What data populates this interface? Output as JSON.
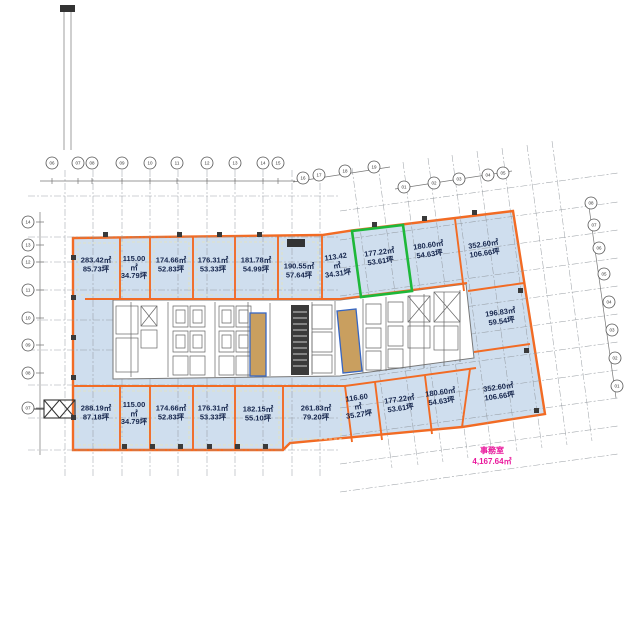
{
  "colors": {
    "lease": "#f26b24",
    "room": "#cfdeee",
    "grid": "#8f959b",
    "green": "#1db83a",
    "strip": "#c99f5f",
    "stripline": "#3766c2",
    "labeltxt": "#15254c",
    "pink": "#e9189c"
  },
  "note": {
    "label": "事務室",
    "value": "4,167.64㎡"
  },
  "rooms": [
    {
      "area": "283.42㎡",
      "tsubo": "85.73坪",
      "x": 96,
      "y": 265,
      "rot": 0,
      "narrow": false,
      "highlight": ""
    },
    {
      "area": "115.00㎡",
      "tsubo": "34.79坪",
      "x": 134,
      "y": 268,
      "rot": 0,
      "narrow": true,
      "highlight": ""
    },
    {
      "area": "174.66㎡",
      "tsubo": "52.83坪",
      "x": 171,
      "y": 265,
      "rot": 0,
      "narrow": false,
      "highlight": ""
    },
    {
      "area": "176.31㎡",
      "tsubo": "53.33坪",
      "x": 213,
      "y": 265,
      "rot": 0,
      "narrow": false,
      "highlight": ""
    },
    {
      "area": "181.78㎡",
      "tsubo": "54.99坪",
      "x": 256,
      "y": 265,
      "rot": 0,
      "narrow": false,
      "highlight": ""
    },
    {
      "area": "190.55㎡",
      "tsubo": "57.64坪",
      "x": 299,
      "y": 271,
      "rot": 0,
      "narrow": false,
      "highlight": ""
    },
    {
      "area": "113.42㎡",
      "tsubo": "34.31坪",
      "x": 337,
      "y": 266,
      "rot": -8,
      "narrow": true,
      "highlight": ""
    },
    {
      "area": "177.22㎡",
      "tsubo": "53.61坪",
      "x": 380,
      "y": 257,
      "rot": -8,
      "narrow": false,
      "highlight": "green"
    },
    {
      "area": "180.60㎡",
      "tsubo": "54.63坪",
      "x": 429,
      "y": 250,
      "rot": -8,
      "narrow": false,
      "highlight": ""
    },
    {
      "area": "352.60㎡",
      "tsubo": "106.66坪",
      "x": 484,
      "y": 249,
      "rot": -8,
      "narrow": false,
      "highlight": ""
    },
    {
      "area": "196.83㎡",
      "tsubo": "59.54坪",
      "x": 501,
      "y": 317,
      "rot": -8,
      "narrow": false,
      "highlight": ""
    },
    {
      "area": "288.19㎡",
      "tsubo": "87.18坪",
      "x": 96,
      "y": 413,
      "rot": 0,
      "narrow": false,
      "highlight": ""
    },
    {
      "area": "115.00㎡",
      "tsubo": "34.79坪",
      "x": 134,
      "y": 414,
      "rot": 0,
      "narrow": true,
      "highlight": ""
    },
    {
      "area": "174.66㎡",
      "tsubo": "52.83坪",
      "x": 171,
      "y": 413,
      "rot": 0,
      "narrow": false,
      "highlight": ""
    },
    {
      "area": "176.31㎡",
      "tsubo": "53.33坪",
      "x": 213,
      "y": 413,
      "rot": 0,
      "narrow": false,
      "highlight": ""
    },
    {
      "area": "182.15㎡",
      "tsubo": "55.10坪",
      "x": 258,
      "y": 414,
      "rot": 0,
      "narrow": false,
      "highlight": ""
    },
    {
      "area": "261.83㎡",
      "tsubo": "79.20坪",
      "x": 316,
      "y": 413,
      "rot": 0,
      "narrow": false,
      "highlight": ""
    },
    {
      "area": "116.60㎡",
      "tsubo": "35.27坪",
      "x": 358,
      "y": 407,
      "rot": -8,
      "narrow": true,
      "highlight": ""
    },
    {
      "area": "177.22㎡",
      "tsubo": "53.61坪",
      "x": 400,
      "y": 404,
      "rot": -8,
      "narrow": false,
      "highlight": ""
    },
    {
      "area": "180.60㎡",
      "tsubo": "54.63坪",
      "x": 441,
      "y": 397,
      "rot": -8,
      "narrow": false,
      "highlight": ""
    },
    {
      "area": "352.60㎡",
      "tsubo": "106.66坪",
      "x": 499,
      "y": 392,
      "rot": -8,
      "narrow": false,
      "highlight": ""
    }
  ],
  "grid_bubbles": {
    "top": [
      {
        "x": 52,
        "y": 163,
        "n": "06"
      },
      {
        "x": 78,
        "y": 163,
        "n": "07"
      },
      {
        "x": 92,
        "y": 163,
        "n": "08"
      },
      {
        "x": 122,
        "y": 163,
        "n": "09"
      },
      {
        "x": 150,
        "y": 163,
        "n": "10"
      },
      {
        "x": 177,
        "y": 163,
        "n": "11"
      },
      {
        "x": 207,
        "y": 163,
        "n": "12"
      },
      {
        "x": 235,
        "y": 163,
        "n": "13"
      },
      {
        "x": 263,
        "y": 163,
        "n": "14"
      },
      {
        "x": 278,
        "y": 163,
        "n": "15"
      }
    ],
    "wing_upper": [
      {
        "x": 303,
        "y": 178,
        "n": "16"
      },
      {
        "x": 319,
        "y": 175,
        "n": "17"
      },
      {
        "x": 345,
        "y": 171,
        "n": "18"
      },
      {
        "x": 374,
        "y": 167,
        "n": "19"
      }
    ],
    "wing_lower": [
      {
        "x": 404,
        "y": 187,
        "n": "01"
      },
      {
        "x": 434,
        "y": 183,
        "n": "02"
      },
      {
        "x": 459,
        "y": 179,
        "n": "03"
      },
      {
        "x": 488,
        "y": 175,
        "n": "04"
      },
      {
        "x": 503,
        "y": 173,
        "n": "05"
      }
    ],
    "left": [
      {
        "x": 28,
        "y": 222,
        "n": "14"
      },
      {
        "x": 28,
        "y": 245,
        "n": "13"
      },
      {
        "x": 28,
        "y": 262,
        "n": "12"
      },
      {
        "x": 28,
        "y": 290,
        "n": "11"
      },
      {
        "x": 28,
        "y": 318,
        "n": "10"
      },
      {
        "x": 28,
        "y": 345,
        "n": "09"
      },
      {
        "x": 28,
        "y": 373,
        "n": "08"
      },
      {
        "x": 28,
        "y": 408,
        "n": "07"
      }
    ],
    "right": [
      {
        "x": 591,
        "y": 203,
        "n": "08"
      },
      {
        "x": 594,
        "y": 225,
        "n": "07"
      },
      {
        "x": 599,
        "y": 248,
        "n": "06"
      },
      {
        "x": 604,
        "y": 274,
        "n": "05"
      },
      {
        "x": 609,
        "y": 302,
        "n": "04"
      },
      {
        "x": 612,
        "y": 330,
        "n": "03"
      },
      {
        "x": 615,
        "y": 358,
        "n": "02"
      },
      {
        "x": 617,
        "y": 386,
        "n": "01"
      }
    ]
  }
}
